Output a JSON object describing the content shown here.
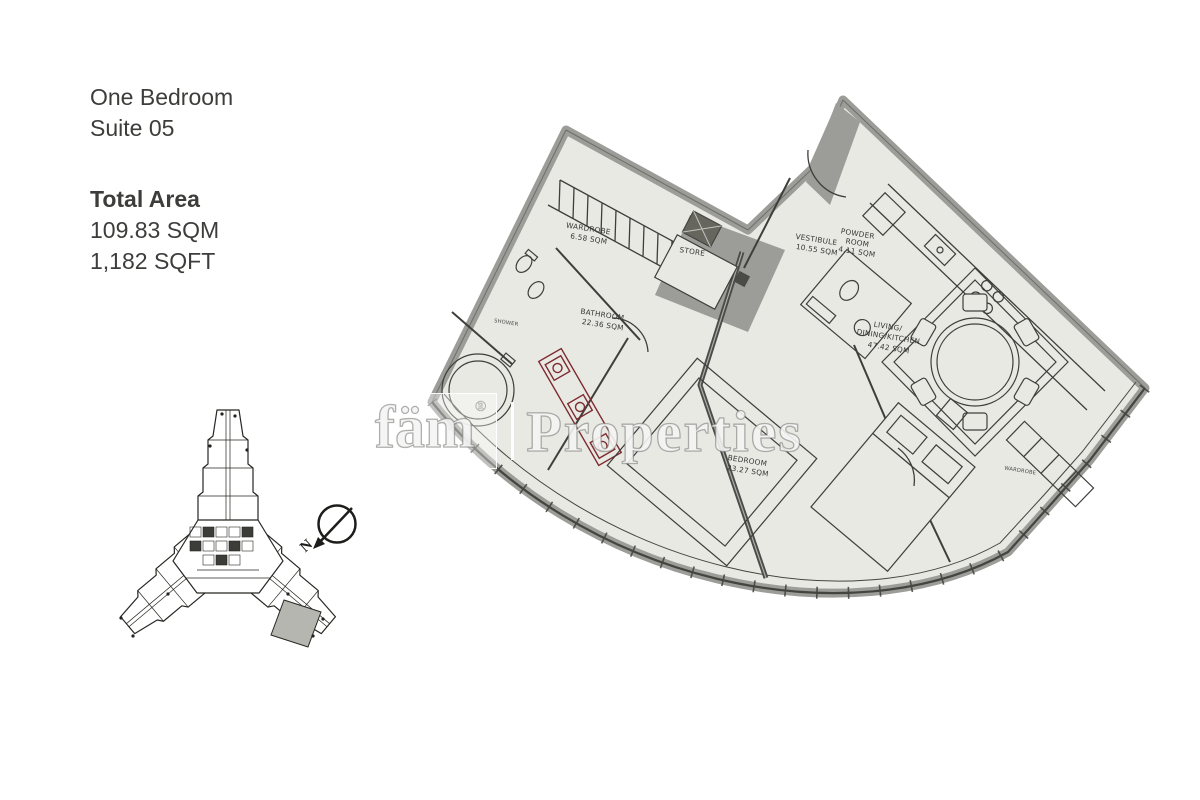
{
  "header": {
    "title_line1": "One Bedroom",
    "title_line2": "Suite 05",
    "total_area_label": "Total Area",
    "area_sqm": "109.83 SQM",
    "area_sqft": "1,182 SQFT"
  },
  "floorplan": {
    "rooms": {
      "wardrobe": {
        "name": "WARDROBE",
        "area": "6.58 SQM"
      },
      "store": {
        "name": "STORE"
      },
      "vestibule": {
        "name": "VESTIBULE",
        "area": "10.55 SQM"
      },
      "powder": {
        "name_line1": "POWDER",
        "name_line2": "ROOM",
        "area": "4.11 SQM"
      },
      "bathroom": {
        "name": "BATHROOM",
        "area": "22.36 SQM"
      },
      "shower": {
        "name": "SHOWER"
      },
      "living": {
        "name_line1": "LIVING/",
        "name_line2": "DINING/KITCHEN",
        "area": "47.42 SQM"
      },
      "bedroom": {
        "name": "BEDROOM",
        "area": "23.27 SQM"
      },
      "bedroom_wardrobe": {
        "name": "WARDROBE"
      }
    },
    "colors": {
      "floor": "#e9e9e4",
      "wall_gray": "#9c9c98",
      "line": "#3e3e3a",
      "fixture_accent_red": "#7d2b30",
      "keyplan_highlight": "#b6b6b0"
    }
  },
  "keyplan": {
    "compass_label": "N"
  },
  "watermark": {
    "brand": "fäm",
    "registered": "®",
    "name": "Properties"
  }
}
